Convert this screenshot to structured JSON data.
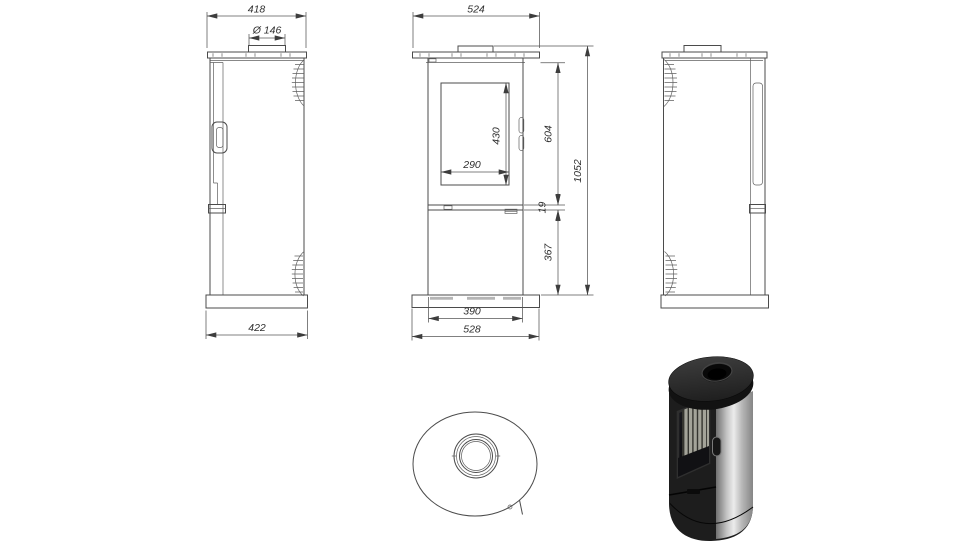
{
  "sheet": {
    "background": "#ffffff",
    "line_color": "#4b4b4b",
    "dim_text_color": "#2f2f2f"
  },
  "views": {
    "side_left": "left-side-view",
    "front": "front-view",
    "side_right": "right-side-view",
    "top": "top-view",
    "render": "stove-3d-render"
  },
  "dimensions": {
    "side_top_width": "418",
    "flue_diameter": "Ø 146",
    "side_base_depth": "422",
    "front_top_width": "524",
    "glass_width": "290",
    "glass_height": "430",
    "upper_section_height": "604",
    "shelf_thickness": "19",
    "lower_section_height": "367",
    "total_height": "1052",
    "base_inner_width": "390",
    "base_outer_width": "528"
  },
  "render_colors": {
    "cap": "#2c2c2c",
    "cap_side": "#121212",
    "body_dark": "#1d1d1d",
    "steel_light": "#ececec",
    "steel_dark": "#707070",
    "glass": "#14141a",
    "firebox_liner": "#a3a399"
  }
}
